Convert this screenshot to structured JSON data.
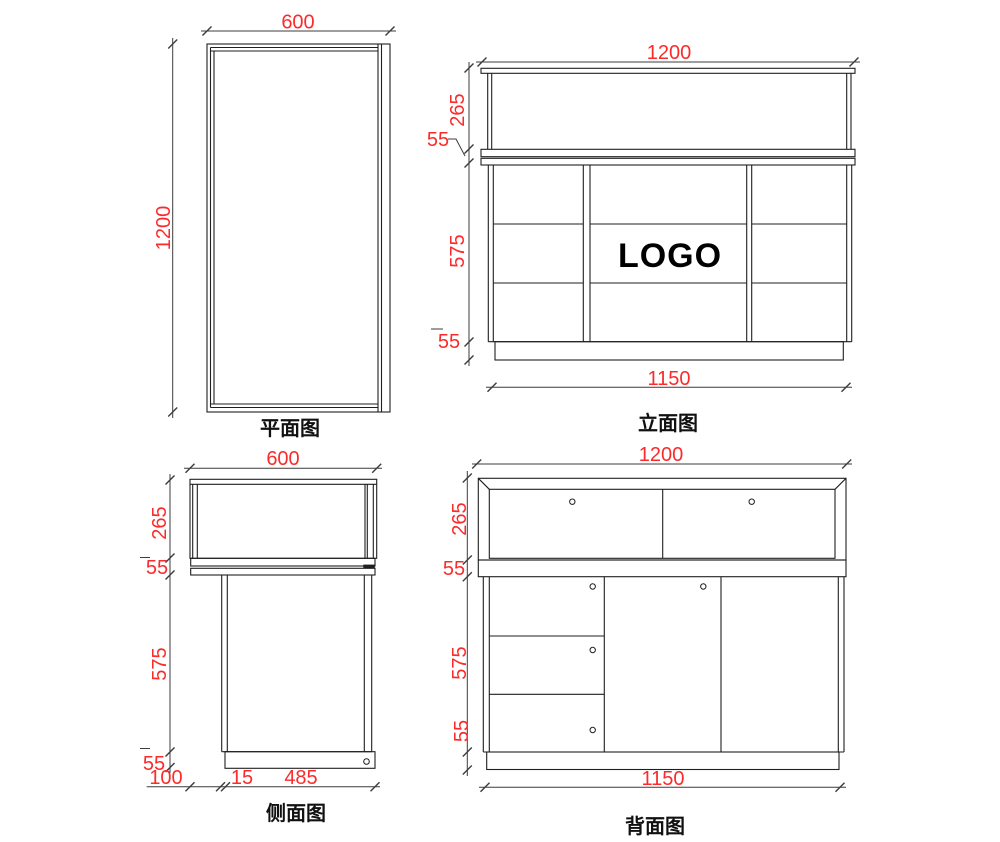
{
  "colors": {
    "line": "#1f1f1f",
    "dimension_line": "#3c3c3c",
    "dimension_text": "#fb2b2b",
    "logo": "#000000",
    "background": "#ffffff"
  },
  "views": {
    "plan": {
      "title": "平面图",
      "width_mm": "600",
      "depth_mm": "1200"
    },
    "elevation": {
      "title": "立面图",
      "logo_text": "LOGO",
      "total_width_mm": "1200",
      "base_width_mm": "1150",
      "display_height_mm": "265",
      "counter_thickness_mm": "55",
      "cabinet_height_mm": "575",
      "plinth_height_mm": "55"
    },
    "side": {
      "title": "侧面图",
      "total_depth_mm": "600",
      "display_height_mm": "265",
      "counter_thickness_mm": "55",
      "cabinet_height_mm": "575",
      "plinth_height_mm": "55",
      "counter_overhang_mm": "100",
      "panel_thickness_mm": "15",
      "cabinet_depth_mm": "485"
    },
    "back": {
      "title": "背面图",
      "total_width_mm": "1200",
      "base_width_mm": "1150",
      "display_height_mm": "265",
      "counter_thickness_mm": "55",
      "cabinet_height_mm": "575",
      "plinth_height_mm": "55"
    }
  }
}
